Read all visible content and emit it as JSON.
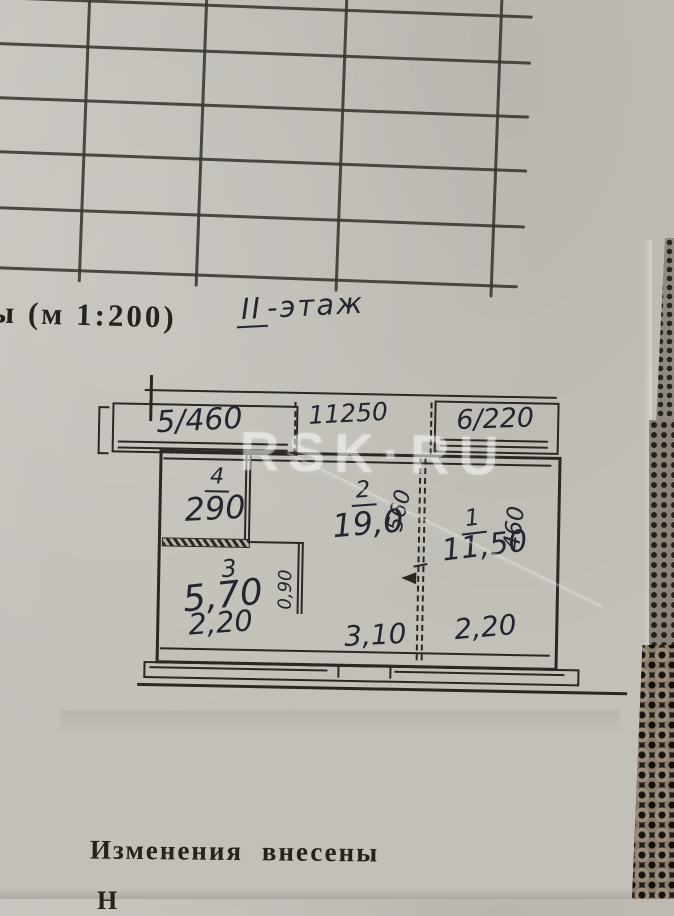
{
  "colors": {
    "paper": "#c3bfb9",
    "ink": "#2b2824",
    "handwriting": "#23262f",
    "watermark": "rgba(255,255,255,0.42)",
    "fabric_dark": "#211c16",
    "fabric_yarn": "#9a8d7c"
  },
  "title": {
    "fragment_left": "ы",
    "scale_label": "(м 1:200)",
    "floor_note_roman": "II",
    "floor_note_word": "-этаж"
  },
  "watermark": {
    "text": "RSK·RU"
  },
  "plan": {
    "balconies": {
      "left": "5/460",
      "right": "6/220"
    },
    "top_dimension": "11250",
    "rooms": {
      "room1": {
        "number": "1",
        "area": "11,50"
      },
      "room2": {
        "number": "2",
        "area": "19,0"
      },
      "room3": {
        "number": "3",
        "area": "5,70"
      },
      "room4": {
        "number": "4",
        "area": "290"
      }
    },
    "dimensions": {
      "depth_room2": "560",
      "depth_room1": "460",
      "corridor": "0,90",
      "bottom_left": "2,20",
      "bottom_middle": "3,10",
      "bottom_right": "2,20"
    }
  },
  "footer": {
    "stamp_text": "Изменения внесены",
    "clipped_letter": "Н"
  }
}
